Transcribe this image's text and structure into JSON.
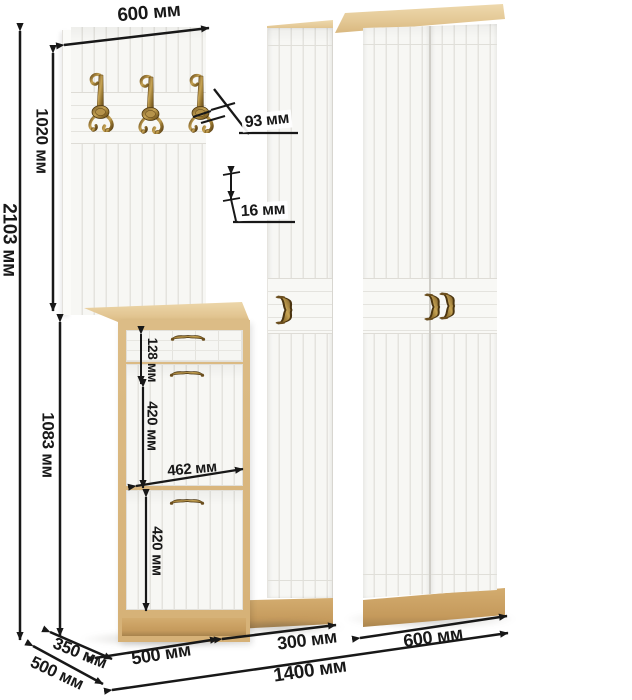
{
  "dimensions": {
    "panel_width_top": "600 мм",
    "total_height": "2103 мм",
    "panel_height": "1020 мм",
    "hook_height": "93 мм",
    "panel_thickness": "16 мм",
    "shoe_cabinet_height": "1083 мм",
    "drawer_height": "128 мм",
    "upper_flap_height": "420 мм",
    "inner_width": "462 мм",
    "lower_flap_height": "420 мм",
    "shoe_cabinet_depth": "350 мм",
    "wardrobe_depth": "500 мм",
    "shoe_cabinet_width": "500 мм",
    "narrow_wardrobe_width": "300 мм",
    "wide_wardrobe_width": "600 мм",
    "total_width": "1400 мм"
  },
  "counts": {
    "coat_hooks": 3,
    "wardrobe_doors": 3,
    "shoe_flaps": 2,
    "drawers": 1
  },
  "colors": {
    "wood_light": "#ead3a4",
    "wood_mid": "#d9b77f",
    "wood_dark": "#c1975b",
    "door_white": "#f7f7f4",
    "groove": "#e4e3de",
    "brass": "#8f7434",
    "annotation": "#181818",
    "background": "#ffffff"
  }
}
